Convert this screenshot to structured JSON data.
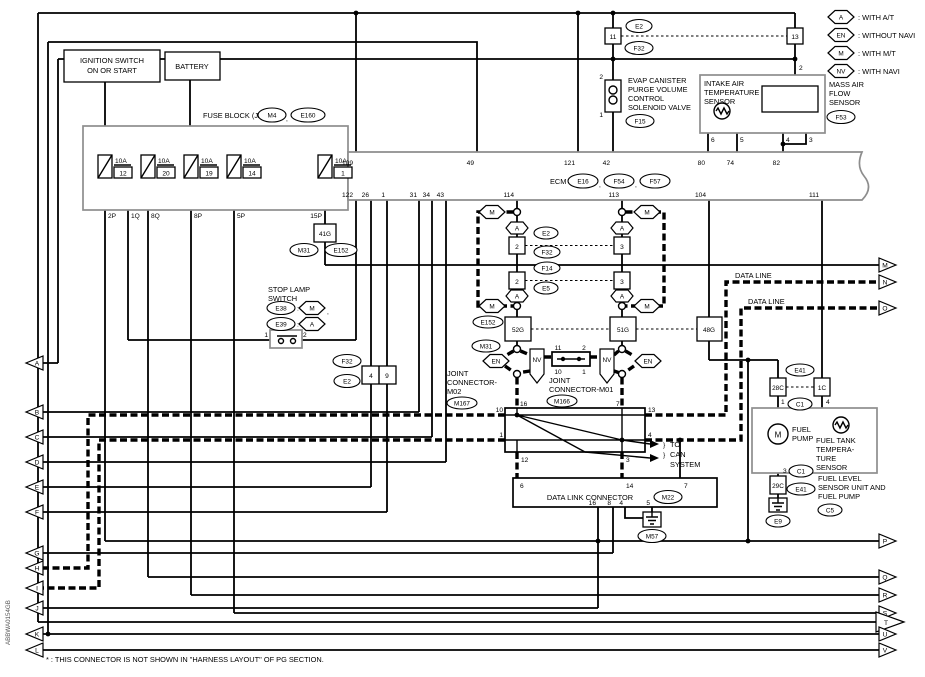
{
  "legend": {
    "items": [
      {
        "badge": "A",
        "text": ": WITH A/T"
      },
      {
        "badge": "EN",
        "text": ": WITHOUT NAVI"
      },
      {
        "badge": "M",
        "text": ": WITH M/T"
      },
      {
        "badge": "NV",
        "text": ": WITH NAVI"
      }
    ]
  },
  "power": {
    "ignition": [
      "IGNITION SWITCH",
      "ON OR START"
    ],
    "battery": "BATTERY"
  },
  "fuse_block": {
    "title": "FUSE BLOCK (J/B)",
    "conn_a": "M4",
    "conn_b": "E160",
    "fuses": [
      {
        "amp": "10A",
        "num": "12"
      },
      {
        "amp": "10A",
        "num": "20"
      },
      {
        "amp": "10A",
        "num": "19"
      },
      {
        "amp": "10A",
        "num": "14"
      },
      {
        "amp": "10A",
        "num": "1"
      }
    ],
    "pins": [
      "2P",
      "1Q",
      "8Q",
      "8P",
      "5P",
      "15P"
    ],
    "sub": "41G",
    "m31": "M31",
    "e152": "E152"
  },
  "ecm": {
    "label": "ECM",
    "conns": [
      "E16",
      "F54",
      "F57"
    ],
    "top": [
      "109",
      "49",
      "121",
      "42",
      "80",
      "74",
      "82"
    ],
    "bottom": [
      "122",
      "26",
      "1",
      "31",
      "34",
      "43",
      "114",
      "113",
      "104",
      "111"
    ]
  },
  "jumper": {
    "l": "11",
    "r": "13",
    "top": "E2",
    "bot": "F32",
    "maf_pin": "2"
  },
  "evap": {
    "p2": "2",
    "p1": "1",
    "name": [
      "EVAP CANISTER",
      "PURGE VOLUME",
      "CONTROL",
      "SOLENOID VALVE"
    ],
    "conn": "F15"
  },
  "iat": {
    "name": [
      "INTAKE AIR",
      "TEMPERATURE",
      "SENSOR"
    ]
  },
  "maf": {
    "name": [
      "MASS AIR",
      "FLOW",
      "SENSOR"
    ],
    "conn": "F53",
    "pins": [
      "6",
      "5",
      "4",
      "3"
    ]
  },
  "stop": {
    "name": [
      "STOP LAMP",
      "SWITCH"
    ],
    "c1": "E38",
    "b1": "M",
    "c2": "E39",
    "b2": "A",
    "p1": "1",
    "p2": "2",
    "colon": ":"
  },
  "inline49": {
    "top": "F32",
    "bot": "E2",
    "l": "4",
    "r": "9"
  },
  "chainL": {
    "m": "M",
    "a": "A",
    "b1": "2",
    "b2": "2",
    "e2": "E2",
    "f32": "F32",
    "f14": "F14",
    "e5": "E5",
    "g": "52G",
    "e152": "E152",
    "m31": "M31",
    "en": "EN",
    "nv": "NV"
  },
  "chainR": {
    "m": "M",
    "a": "A",
    "b1": "3",
    "b2": "3",
    "g": "51G",
    "g48": "48G",
    "en": "EN",
    "nv": "NV"
  },
  "jc2": {
    "name": [
      "JOINT",
      "CONNECTOR-",
      "M02"
    ],
    "conn": "M167",
    "p": {
      "tl": "16",
      "tr": "7",
      "lt": "10",
      "lb": "1",
      "rt": "13",
      "rb": "4",
      "bl": "12",
      "br": "3"
    }
  },
  "jc1": {
    "name": [
      "JOINT",
      "CONNECTOR-M01"
    ],
    "conn": "M166",
    "p": [
      "11",
      "10",
      "2",
      "1"
    ]
  },
  "can": {
    "brace": "}",
    "lines": [
      "TO",
      "CAN",
      "SYSTEM"
    ]
  },
  "dl": "DATA LINE",
  "dlc": {
    "title": "DATA LINK CONNECTOR",
    "conn": "M22",
    "top": [
      "6",
      "14",
      "7"
    ],
    "bottom": [
      "16",
      "8",
      "4",
      "5"
    ],
    "gnd": "M57"
  },
  "fuel": {
    "c28": "28C",
    "c1c": "1C",
    "e41t": "E41",
    "c1t": "C1",
    "p1": "1",
    "p4": "4",
    "pump": [
      "FUEL",
      "PUMP"
    ],
    "tank": [
      "FUEL TANK",
      "TEMPERA-",
      "TURE",
      "SENSOR"
    ],
    "p3": "3",
    "c1b": "C1",
    "c29": "29C",
    "e41b": "E41",
    "unit": [
      "FUEL LEVEL",
      "SENSOR UNIT AND",
      "FUEL PUMP"
    ],
    "c5": "C5",
    "e9": "E9"
  },
  "arrows": {
    "left": [
      "A",
      "B",
      "C",
      "D",
      "E",
      "F",
      "G",
      "H",
      "I",
      "J",
      "K",
      "L"
    ],
    "right": [
      "M",
      "N",
      "O",
      "P",
      "Q",
      "R",
      "S",
      "T",
      "U",
      "V"
    ]
  },
  "footnote": "* : THIS CONNECTOR IS NOT SHOWN IN \"HARNESS LAYOUT\" OF PG SECTION.",
  "doc_code": "ABBWA0154GB",
  "comma": ",",
  "colors": {
    "wire": "#000000",
    "frame": "#8d8d8d",
    "bg": "#ffffff"
  }
}
